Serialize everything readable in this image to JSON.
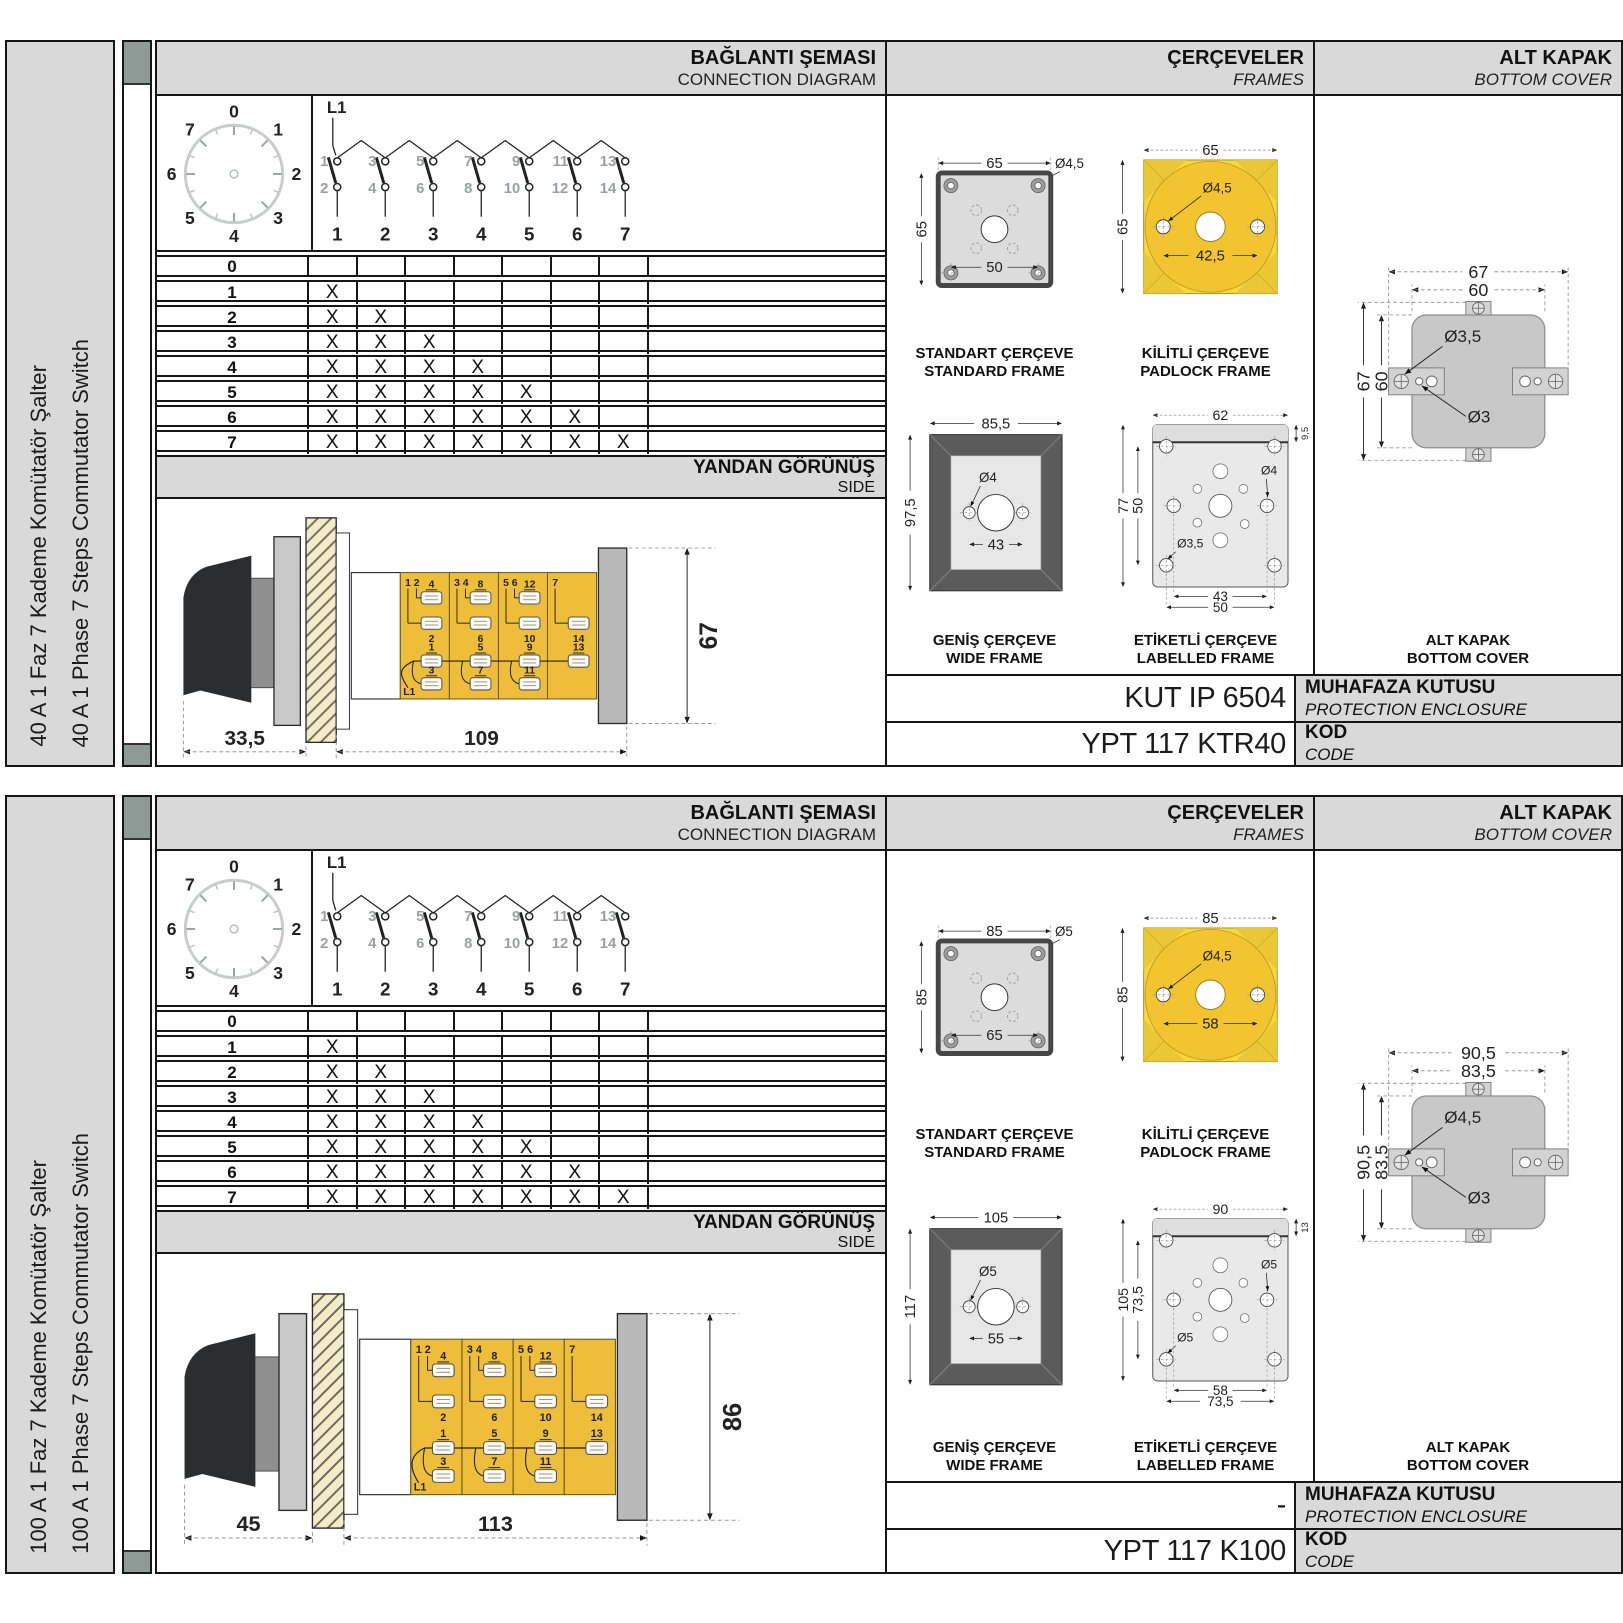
{
  "page": {
    "bg_color": "#ffffff",
    "panel_gray": "#d9d9d9",
    "accent_yellow": "#f8d839",
    "body_yellow": "#eebd39",
    "strip_color": "#8d9a96"
  },
  "shared": {
    "header": {
      "connection_tr": "BAĞLANTI ŞEMASI",
      "connection_en": "CONNECTION DIAGRAM",
      "frames_tr": "ÇERÇEVELER",
      "frames_en": "FRAMES",
      "cover_tr": "ALT KAPAK",
      "cover_en": "BOTTOM COVER"
    },
    "dial_positions": [
      "0",
      "1",
      "2",
      "3",
      "4",
      "5",
      "6",
      "7"
    ],
    "connection": {
      "l1": "L1",
      "top_contacts": [
        "1",
        "3",
        "5",
        "7",
        "9",
        "11",
        "13"
      ],
      "bottom_contacts": [
        "2",
        "4",
        "6",
        "8",
        "10",
        "12",
        "14"
      ],
      "columns": [
        "1",
        "2",
        "3",
        "4",
        "5",
        "6",
        "7"
      ]
    },
    "table": {
      "row_labels": [
        "0",
        "1",
        "2",
        "3",
        "4",
        "5",
        "6",
        "7"
      ],
      "marks_per_row": [
        0,
        1,
        2,
        3,
        4,
        5,
        6,
        7
      ],
      "mark": "X"
    },
    "side_band": {
      "tr": "YANDAN GÖRÜNÜŞ",
      "en": "SIDE"
    },
    "side_segments": [
      {
        "corner": "1 2",
        "top": "4",
        "mid": "2",
        "low_a": "1",
        "low_b": "3"
      },
      {
        "corner": "3 4",
        "top": "8",
        "mid": "6",
        "low_a": "5",
        "low_b": "7"
      },
      {
        "corner": "5 6",
        "top": "12",
        "mid": "10",
        "low_a": "9",
        "low_b": "11"
      },
      {
        "corner": "7",
        "top": "",
        "mid": "14",
        "low_a": "13",
        "low_b": ""
      }
    ],
    "captions": {
      "standard_tr": "STANDART ÇERÇEVE",
      "standard_en": "STANDARD FRAME",
      "padlock_tr": "KİLİTLİ ÇERÇEVE",
      "padlock_en": "PADLOCK FRAME",
      "wide_tr": "GENİŞ ÇERÇEVE",
      "wide_en": "WIDE FRAME",
      "labelled_tr": "ETİKETLİ ÇERÇEVE",
      "labelled_en": "LABELLED FRAME",
      "cover_tr": "ALT KAPAK",
      "cover_en": "BOTTOM COVER"
    },
    "footer": {
      "enclosure_tr": "MUHAFAZA KUTUSU",
      "enclosure_en": "PROTECTION ENCLOSURE",
      "code_tr": "KOD",
      "code_en": "CODE"
    }
  },
  "sections": [
    {
      "sidebar": {
        "line_tr": "40 A 1 Faz 7 Kademe Komütatör Şalter",
        "line_en": "40 A 1 Phase 7 Steps Commutator Switch"
      },
      "side_view": {
        "dim_front": "33,5",
        "dim_body": "109",
        "dim_height": "67"
      },
      "frames": {
        "standard": {
          "w": "65",
          "h": "65",
          "hole": "Ø4,5",
          "pitch": "50"
        },
        "padlock": {
          "w": "65",
          "h": "65",
          "hole": "Ø4,5",
          "pitch": "42,5"
        },
        "wide": {
          "w": "85,5",
          "h": "97,5",
          "hole": "Ø4",
          "pitch": "43"
        },
        "labelled": {
          "w": "62",
          "strip": "9,5",
          "h": "77",
          "inner_h": "50",
          "hole_mid": "Ø4",
          "hole_corner": "Ø3,5",
          "pitch_inner": "43",
          "pitch_outer": "50"
        }
      },
      "cover": {
        "w_outer": "67",
        "w_inner": "60",
        "h_outer": "67",
        "h_inner": "60",
        "hole_tab": "Ø3,5",
        "hole_small": "Ø3"
      },
      "enclosure_value": "KUT IP 6504",
      "code_value": "YPT 117 KTR40"
    },
    {
      "sidebar": {
        "line_tr": "100 A 1 Faz 7 Kademe Komütatör Şalter",
        "line_en": "100 A 1 Phase 7 Steps Commutator Switch"
      },
      "side_view": {
        "dim_front": "45",
        "dim_body": "113",
        "dim_height": "86"
      },
      "frames": {
        "standard": {
          "w": "85",
          "h": "85",
          "hole": "Ø5",
          "pitch": "65"
        },
        "padlock": {
          "w": "85",
          "h": "85",
          "hole": "Ø4,5",
          "pitch": "58"
        },
        "wide": {
          "w": "105",
          "h": "117",
          "hole": "Ø5",
          "pitch": "55"
        },
        "labelled": {
          "w": "90",
          "strip": "13",
          "h": "105",
          "inner_h": "73,5",
          "hole_mid": "Ø5",
          "hole_corner": "Ø5",
          "pitch_inner": "58",
          "pitch_outer": "73,5"
        }
      },
      "cover": {
        "w_outer": "90,5",
        "w_inner": "83,5",
        "h_outer": "90,5",
        "h_inner": "83,5",
        "hole_tab": "Ø4,5",
        "hole_small": "Ø3"
      },
      "enclosure_value": "-",
      "code_value": "YPT 117 K100"
    }
  ]
}
